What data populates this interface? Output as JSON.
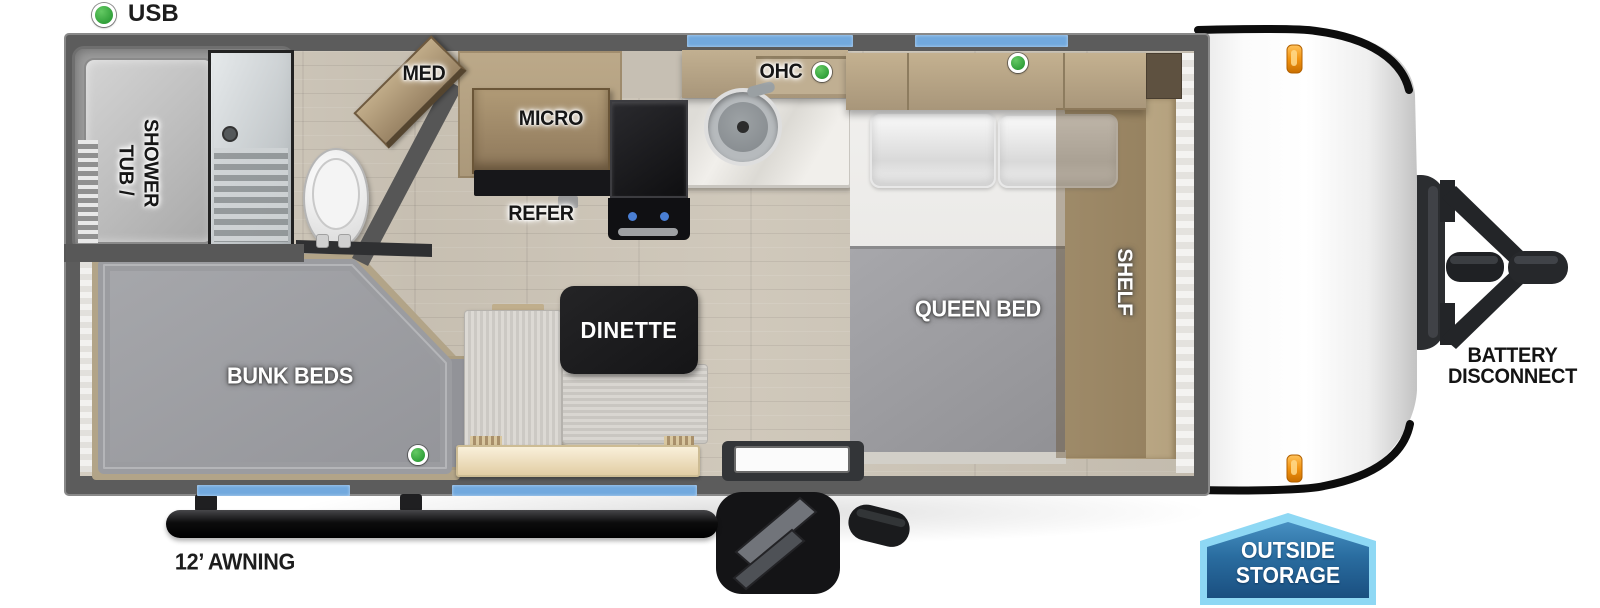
{
  "legend": {
    "usb": "USB"
  },
  "rooms": {
    "bathroom": {
      "tub_shower_line1": "TUB /",
      "tub_shower_line2": "SHOWER",
      "med": "MED"
    },
    "kitchen": {
      "micro": "MICRO",
      "refer": "REFER",
      "ohc": "OHC"
    },
    "bedroom": {
      "queen_bed": "QUEEN BED",
      "shelf": "SHELF"
    },
    "bunk_room": {
      "bunk_beds": "BUNK BEDS"
    },
    "dinette": {
      "label": "DINETTE"
    }
  },
  "exterior": {
    "awning": "12’ AWNING",
    "battery_disconnect_line1": "BATTERY",
    "battery_disconnect_line2": "DISCONNECT",
    "outside_storage_line1": "OUTSIDE",
    "outside_storage_line2": "STORAGE"
  },
  "usb_indicators": [
    {
      "location": "legend"
    },
    {
      "location": "kitchen-overhead-cabinet"
    },
    {
      "location": "queen-bed-overhead-cabinet"
    },
    {
      "location": "bunk-bed"
    }
  ],
  "colors": {
    "wall": "#5c5c5c",
    "window_blue": "#72a9de",
    "usb_green": "#38a43e",
    "marker_orange": "#f29310",
    "outside_badge_border": "#8ed8f4",
    "outside_badge_fill": "#22598b",
    "dinette_badge": "#1c1c1e",
    "mattress_gray": "#9da0a4",
    "cabinet_wood": "#b3a183"
  }
}
